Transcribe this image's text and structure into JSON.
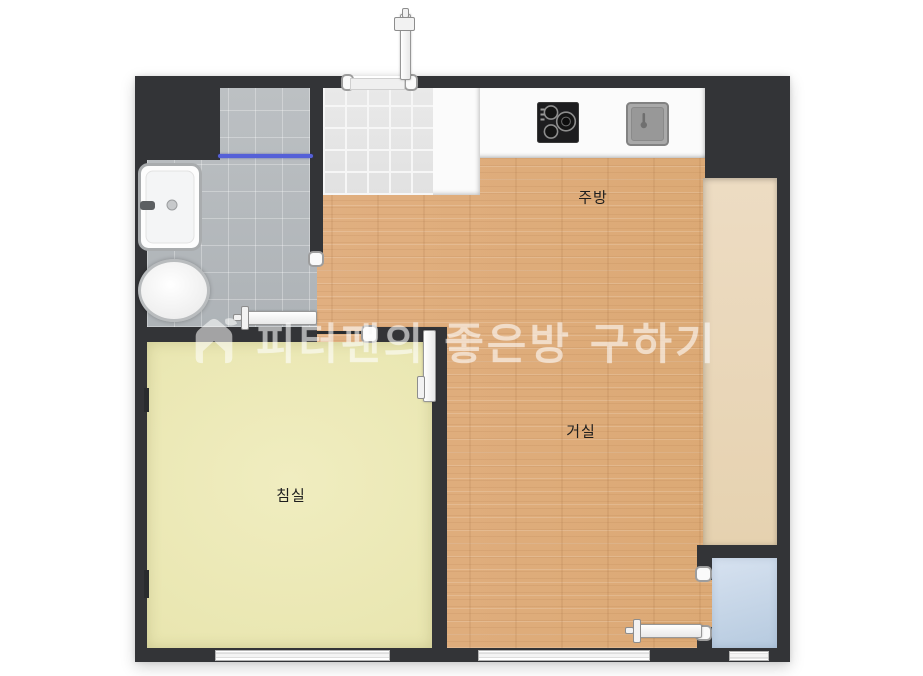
{
  "watermark": {
    "icon": "house-logo-icon",
    "text": "피터팬의 좋은방 구하기"
  },
  "rooms": {
    "kitchen": {
      "label": "주방"
    },
    "living": {
      "label": "거실"
    },
    "bedroom": {
      "label": "침실"
    },
    "bathroom": {
      "label": ""
    },
    "entry": {
      "label": ""
    },
    "balcony": {
      "label": ""
    },
    "utility": {
      "label": ""
    }
  },
  "fixtures": [
    "washbasin",
    "toilet",
    "shower-partition-rail",
    "cooktop",
    "kitchen-sink",
    "entrance-swing-door",
    "bedroom-swing-door",
    "bedroom-sliding-door",
    "utility-sliding-door",
    "window-bedroom",
    "window-living",
    "window-utility"
  ],
  "colors": {
    "wall": "#333437",
    "wood_floor": "#deac7b",
    "bedroom_floor": "#ebe8b4",
    "balcony_floor": "#e9d7ba",
    "utility_floor": "#c6d6e9",
    "bathroom_tile": "#b6babd",
    "entry_tile": "#e5e5e5",
    "counter": "#fbfbfb",
    "shower_rail_blue": "#5560d8",
    "background": "#ffffff"
  }
}
